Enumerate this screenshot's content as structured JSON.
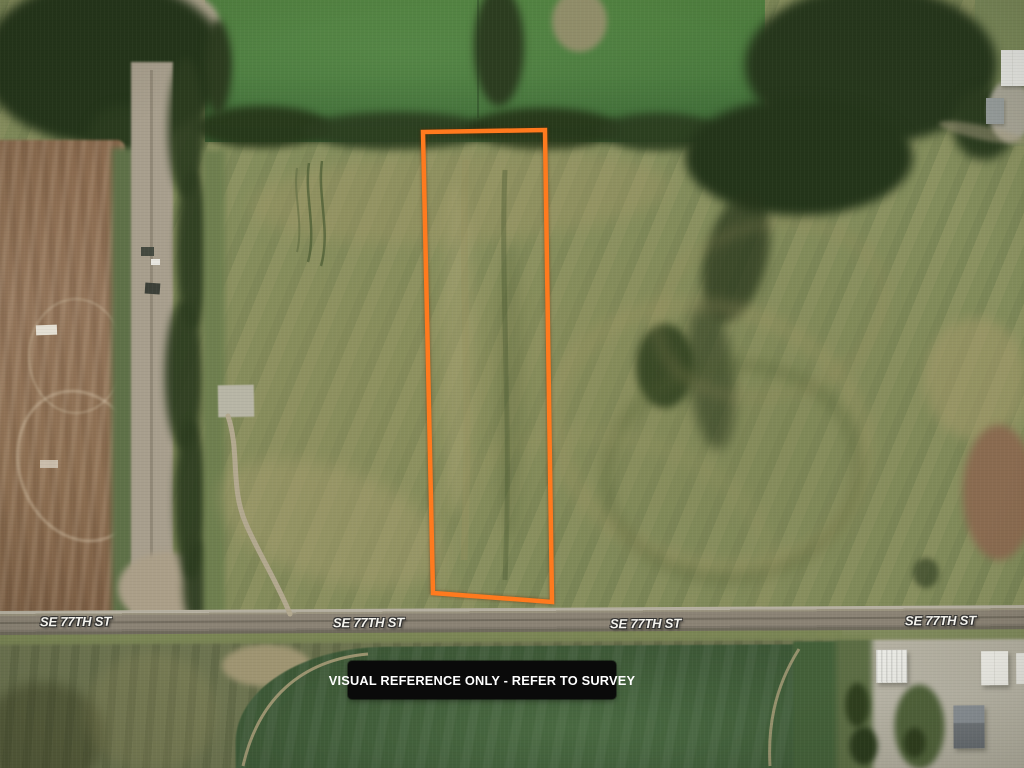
{
  "map": {
    "kind": "aerial-satellite-parcel-map",
    "street_labels": [
      "SE 77TH ST",
      "SE 77TH ST",
      "SE 77TH ST",
      "SE 77TH ST"
    ],
    "banner": {
      "text": "VISUAL REFERENCE ONLY - REFER TO SURVEY",
      "background": "#0a0a0a",
      "color": "#ffffff"
    },
    "parcel_boundary": {
      "color": "#ff7a1e",
      "stroke_width": "4.5",
      "points": "423,132 545,130 552,602 433,593"
    }
  }
}
